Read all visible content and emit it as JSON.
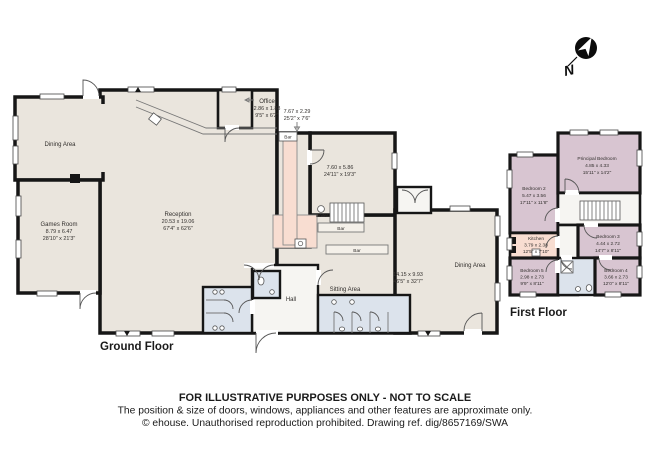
{
  "compass": {
    "label": "N"
  },
  "colors": {
    "wall": "#161616",
    "room_beige": "#eae5dd",
    "bar_pink": "#f8ddd1",
    "wet_room_blue": "#dce3ec",
    "bedroom_mauve": "#d8c5d1",
    "hall_white": "#f6f5f2"
  },
  "ground_floor": {
    "title": "Ground Floor",
    "rooms": {
      "dining_left": {
        "name": "Dining Area"
      },
      "games_room": {
        "name": "Games Room",
        "metric": "8.79 x 6.47",
        "imperial": "28'10\" x 21'3\""
      },
      "reception": {
        "name": "Reception",
        "metric": "20.53 x 19.06",
        "imperial": "67'4\" x 62'6\""
      },
      "office": {
        "name": "Office",
        "metric": "2.86 x 1.88",
        "imperial": "9'5\" x 6'2\""
      },
      "bar": {
        "name": "Bar",
        "metric": "7.67 x 2.29",
        "imperial": "25'2\" x 7'6\""
      },
      "lounge": {
        "metric": "7.60 x 5.86",
        "imperial": "24'11\" x 19'3\""
      },
      "boiler": {
        "name": "Boiler"
      },
      "bar_counter_upper": {
        "name": "Bar"
      },
      "bar_counter_lower": {
        "name": "Bar"
      },
      "sitting_area": {
        "name": "Sitting Area"
      },
      "function_room": {
        "metric": "14.15 x 9.93",
        "imperial": "46'5\" x 32'7\""
      },
      "dining_right": {
        "name": "Dining Area"
      },
      "hall": {
        "name": "Hall"
      }
    }
  },
  "first_floor": {
    "title": "First Floor",
    "rooms": {
      "principal_bedroom": {
        "name": "Principal Bedroom",
        "metric": "4.85 x 4.33",
        "imperial": "15'11\" x 14'2\""
      },
      "bedroom_2": {
        "name": "Bedroom 2",
        "metric": "5.47 x 3.56",
        "imperial": "17'11\" x 11'8\""
      },
      "kitchen": {
        "name": "Kitchen",
        "metric": "3.79 x 2.38",
        "imperial": "12'5\" x 7'10\""
      },
      "bedroom_3": {
        "name": "Bedroom 3",
        "metric": "4.44 x 2.72",
        "imperial": "14'7\" x 8'11\""
      },
      "bedroom_4": {
        "name": "Bedroom 4",
        "metric": "3.66 x 2.73",
        "imperial": "12'0\" x 8'11\""
      },
      "bedroom_5": {
        "name": "Bedroom 5",
        "metric": "2.98 x 2.73",
        "imperial": "9'9\" x 8'11\""
      }
    }
  },
  "footer": {
    "line1": "FOR ILLUSTRATIVE PURPOSES ONLY - NOT TO SCALE",
    "line2": "The position & size of doors, windows, appliances and other features are approximate only.",
    "line3": "© ehouse. Unauthorised reproduction prohibited. Drawing ref. dig/8657169/SWA"
  }
}
